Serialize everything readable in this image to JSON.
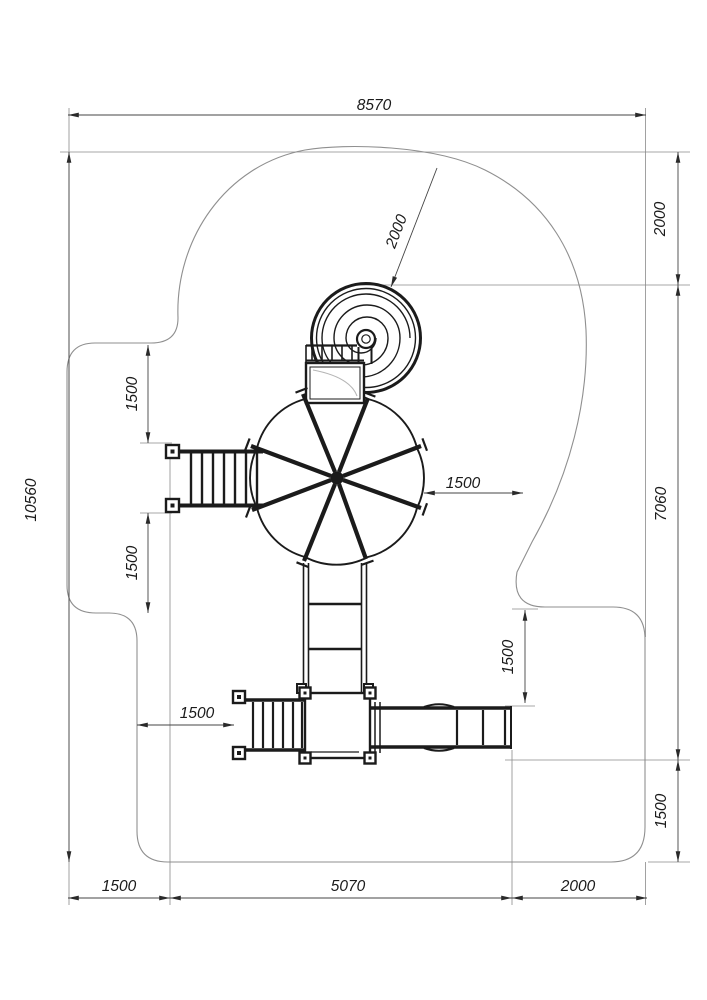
{
  "dimensions": {
    "overall_width": "8570",
    "overall_height": "10560",
    "right_top_offset": "2000",
    "right_span": "7060",
    "right_bottom_offset": "1500",
    "bottom_left_offset": "1500",
    "bottom_span": "5070",
    "bottom_right_offset": "2000",
    "spiral_clearance_radius": "2000",
    "left_upper_offset": "1500",
    "left_lower_offset": "1500",
    "stairs_left_offset": "1500",
    "platform_right_offset": "1500",
    "slide_top_offset": "1500"
  }
}
